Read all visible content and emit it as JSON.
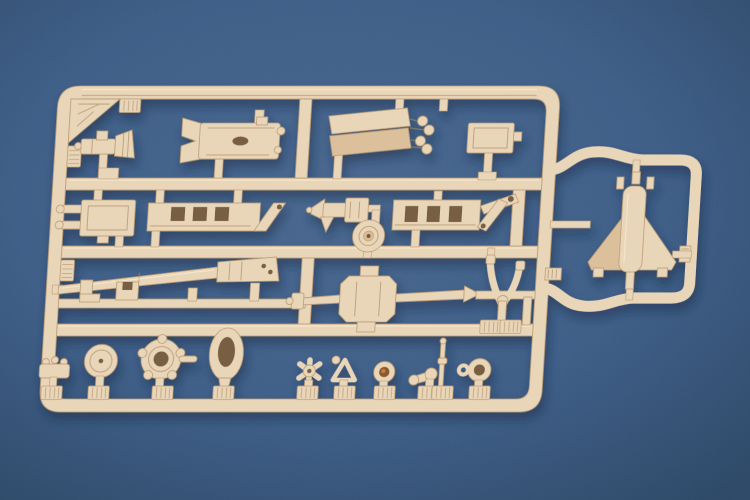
{
  "scene": {
    "description": "Close-up photograph of a tan injection-molded model kit sprue (parts runner) lying on a blue studio backdrop",
    "colors": {
      "background_center": "#48678f",
      "background_mid": "#3d5e88",
      "background_edge": "#2c4867",
      "plastic": "#e9d5b8",
      "plastic_dark": "#bb9b73",
      "plastic_deep": "#a8875f",
      "plastic_light": "#f7ecd6",
      "recess_dark": "#6b5136",
      "copper_glint": "#c97f3a",
      "cast_shadow": "#16253c"
    }
  },
  "sprue": {
    "material": "tan styrene plastic",
    "frame": {
      "main": "rounded rectangular runner frame with three internal horizontal rails and short vertical rails",
      "extension": "arched runner loop on the right side holding the rocket tail-fin part",
      "corner_gusset": "ribbed triangular web in the top-left corner"
    },
    "parts": [
      {
        "name": "recoil-cylinder",
        "description": "small cylinder with flared trumpet end, top left row"
      },
      {
        "name": "gun-cradle",
        "description": "rectangular cradle with forked left end and oval slot"
      },
      {
        "name": "trail-spade-blades",
        "description": "pair of angled spade blades with four round knobs"
      },
      {
        "name": "stowage-box",
        "description": "small rectangular equipment box on a post"
      },
      {
        "name": "breech-block",
        "description": "rectangular breech block with two pronged rods"
      },
      {
        "name": "left-trail-frame",
        "description": "long trail rail with three rectangular openings and diagonal brace"
      },
      {
        "name": "recoil-mechanism",
        "description": "small gun-shaped recoil assembly with conical nose"
      },
      {
        "name": "right-trail-frame",
        "description": "long trail rail with slots, raised arm and diagonal strut"
      },
      {
        "name": "wheel-hub",
        "description": "round ribbed hub disc"
      },
      {
        "name": "gun-barrel-half",
        "description": "long tapered barrel half with breech block at right"
      },
      {
        "name": "barrel-brackets",
        "description": "two small angle brackets below the barrel"
      },
      {
        "name": "axle-beam",
        "description": "central cradle block with long axle arms and arrow-shaped end"
      },
      {
        "name": "elevation-fork",
        "description": "Y-shaped wishbone fork"
      },
      {
        "name": "filler-cap-fitting",
        "description": "tiny knurled cylinder fitting"
      },
      {
        "name": "road-wheel",
        "description": "solid disc wheel"
      },
      {
        "name": "traverse-platform",
        "description": "round platform with edge lugs, centre hole and side pin"
      },
      {
        "name": "tire-ring",
        "description": "tall oval ring with open centre"
      },
      {
        "name": "handwheel",
        "description": "small five-spoke star handwheel"
      },
      {
        "name": "sight-bracket",
        "description": "small triangular bracket with ball fitting"
      },
      {
        "name": "muzzle-socket",
        "description": "round socket with dark coppery recess"
      },
      {
        "name": "linkage-rod",
        "description": "small dumbbell-shaped linkage"
      },
      {
        "name": "pin-rod",
        "description": "thin vertical pin"
      },
      {
        "name": "towing-eye",
        "description": "ring with small side loop"
      },
      {
        "name": "rocket-tail-fins",
        "description": "delta-finned rocket tail unit inside right extension loop"
      }
    ],
    "gate_tabs": "ribbed rectangular gate tabs along the bottom rail, left rail and extension rail"
  }
}
